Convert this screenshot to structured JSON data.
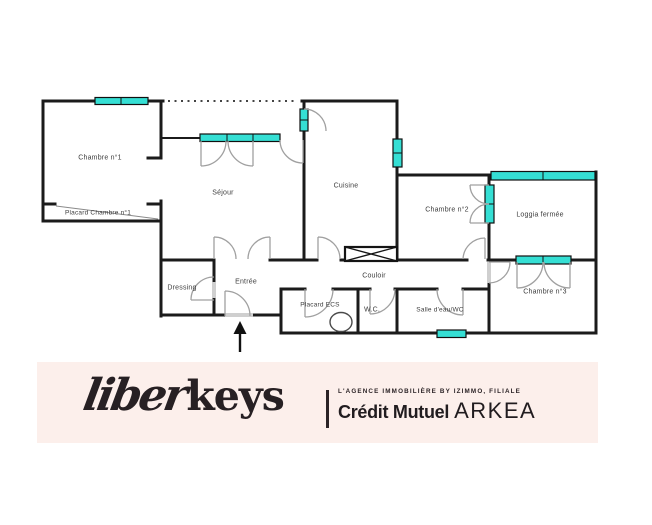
{
  "plan": {
    "rooms": {
      "chambre1": "Chambre n°1",
      "placard_chambre1": "Placard Chambre n°1",
      "sejour": "Séjour",
      "cuisine": "Cuisine",
      "chambre2": "Chambre n°2",
      "loggia": "Loggia fermée",
      "dressing": "Dressing",
      "entree": "Entrée",
      "couloir": "Couloir",
      "placard_ecs": "Placard ECS",
      "wc": "W.C.",
      "salle_eau": "Salle d'eau/WC",
      "chambre3": "Chambre n°3"
    },
    "colors": {
      "window": "#35dfd4",
      "wall": "#1b1b1b",
      "door": "#a0a0a0"
    }
  },
  "footer": {
    "logo_liber": "liber",
    "logo_keys": "keys",
    "tagline": "L'AGENCE IMMOBILIÈRE BY IZIMMO, FILIALE",
    "brand_bold": "Crédit Mutuel",
    "brand_caps": "ARKEA",
    "colors": {
      "band_bg": "#fcefeb",
      "logo_dark": "#2b2326"
    }
  }
}
